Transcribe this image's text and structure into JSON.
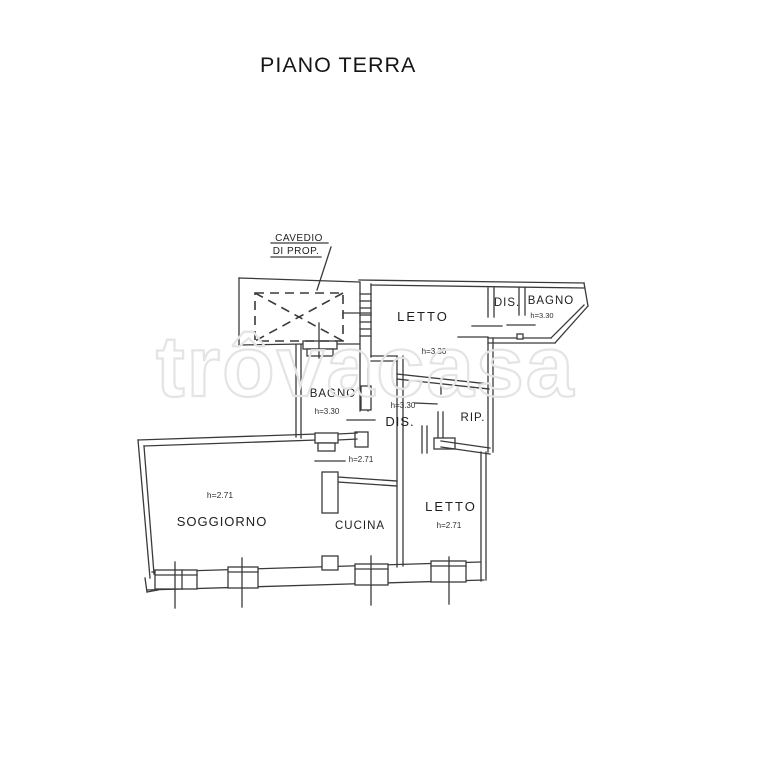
{
  "title": "PIANO TERRA",
  "watermark": "trôvacasa",
  "plan": {
    "annotations": {
      "cavedio_line1": "CAVEDIO",
      "cavedio_line2": "DI PROP."
    },
    "rooms": {
      "letto_top": {
        "label": "LETTO",
        "height": "h=3.30"
      },
      "dis_top": {
        "label": "DIS."
      },
      "bagno_top": {
        "label": "BAGNO",
        "height": "h=3.30"
      },
      "bagno_mid": {
        "label": "BAGNO",
        "height": "h=3.30"
      },
      "dis_mid": {
        "label": "DIS.",
        "height": "h=3.30"
      },
      "rip": {
        "label": "RIP."
      },
      "corridor": {
        "height": "h=2.71"
      },
      "soggiorno": {
        "label": "SOGGIORNO",
        "height": "h=2.71"
      },
      "cucina": {
        "label": "CUCINA"
      },
      "letto_bottom": {
        "label": "LETTO",
        "height": "h=2.71"
      }
    },
    "colors": {
      "line": "#3a3a3a",
      "text": "#1f1f1f",
      "watermark_outline": "#e4e4e4",
      "background": "#ffffff"
    }
  }
}
